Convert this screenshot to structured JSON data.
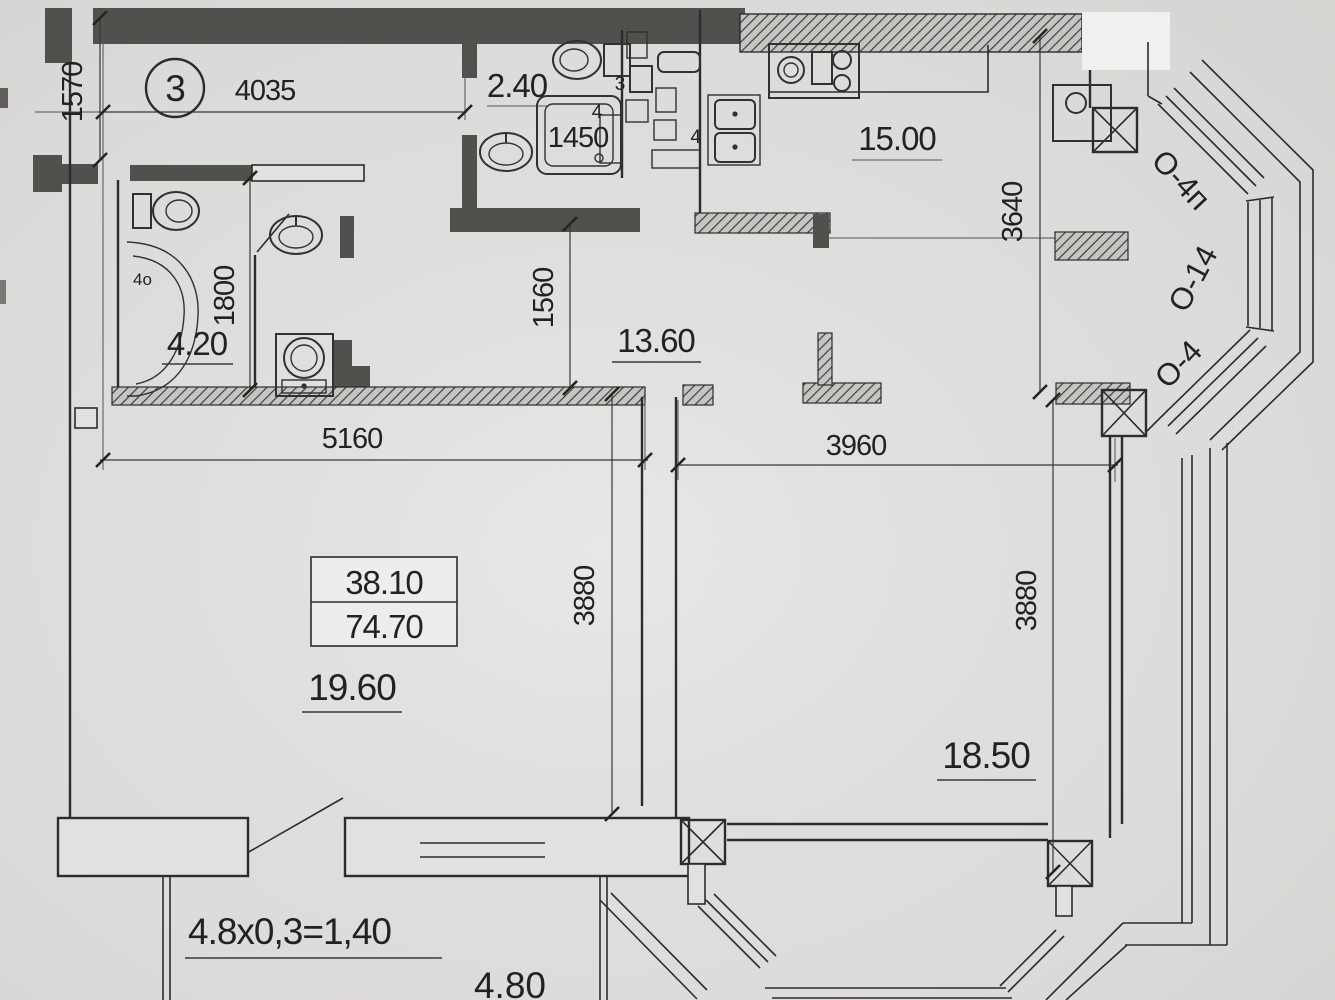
{
  "plan": {
    "apartment_number": "3",
    "rooms": {
      "bathroom_small_area": "2.40",
      "bathroom_area": "4.20",
      "kitchen_area": "15.00",
      "hallway_area": "13.60",
      "living_room_area": "19.60",
      "bedroom_area": "18.50"
    },
    "area_table": {
      "living_area": "38.10",
      "total_area": "74.70"
    },
    "dimensions": {
      "top_width": "4035",
      "entry_width": "1570",
      "shower": "1450",
      "hallway_width": "1560",
      "bathroom_depth": "1800",
      "kitchen_depth": "3640",
      "living_width": "5160",
      "bedroom_width": "3960",
      "living_depth": "3880",
      "bedroom_depth": "3880"
    },
    "balcony": {
      "area_formula": "4.8x0,3=1,40",
      "width": "4.80"
    },
    "window_labels": {
      "top": "О-4п",
      "middle": "О-14",
      "bottom": "О-4"
    },
    "fixture_labels": {
      "vent_a": "3",
      "vent_b": "4",
      "kitchen_sink": "4",
      "bathtub": "4о"
    }
  }
}
